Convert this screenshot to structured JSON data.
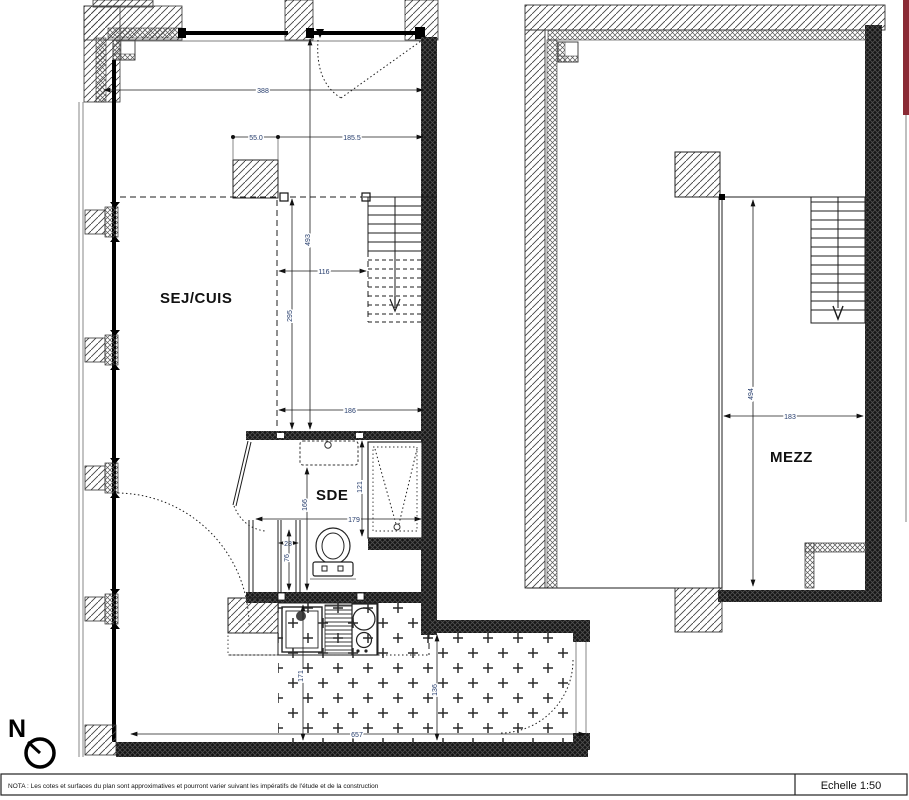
{
  "plan": {
    "north_label": "N",
    "rooms": {
      "sej_cuis": "SEJ/CUIS",
      "sde": "SDE",
      "mezz": "MEZZ"
    },
    "dimensions": {
      "top_total": "388",
      "top_seg_left": "55.0",
      "top_seg_right": "185.5",
      "left_height_total": "493",
      "left_height_lower": "295",
      "stair_width": "116",
      "sde_top_width": "186",
      "shower_depth": "121",
      "sde_mid_width": "179",
      "sde_left_height": "166",
      "wc_niche_width": "28",
      "wc_niche_depth": "76",
      "terrace_width": "657",
      "terrace_left_height": "171",
      "terrace_right_height": "136",
      "mezz_width": "183",
      "mezz_depth": "494"
    },
    "footer": {
      "nota": "NOTA : Les cotes et surfaces du plan sont approximatives et pourront varier suivant les impératifs de l'étude et de la construction",
      "scale": "Echelle 1:50"
    },
    "colors": {
      "accent_strip": "#8b2a35"
    }
  }
}
